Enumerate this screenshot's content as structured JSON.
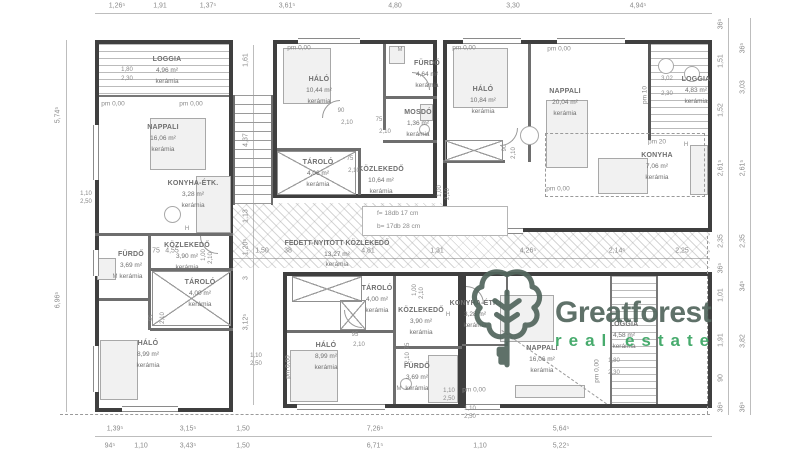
{
  "colors": {
    "wall": "#3f3f3f",
    "partition": "#6e6e6e",
    "text": "#8a8a8a",
    "label": "#6f6f6f",
    "logo_dark": "#53675e",
    "logo_green": "#3aa563"
  },
  "logo": {
    "name": "Greatforest",
    "tagline": "real estate",
    "icon": "tree-key-icon"
  },
  "walkway": {
    "name": "FEDETT-NYITOTT KÖZLEKEDŐ",
    "area": "13,27 m²",
    "finish": "kerámia"
  },
  "stair_note": {
    "line1": "f= 18db 17 cm",
    "line2": "b= 17db 28 cm"
  },
  "rooms": [
    {
      "name": "LOGGIA",
      "area": "4,96 m²",
      "finish": "kerámia",
      "x": 167,
      "y": 54
    },
    {
      "name": "NAPPALI",
      "area": "16,06 m²",
      "finish": "kerámia",
      "x": 163,
      "y": 122
    },
    {
      "name": "KONYHA-ÉTK.",
      "area": "3,28 m²",
      "finish": "kerámia",
      "x": 193,
      "y": 178
    },
    {
      "name": "KÖZLEKEDŐ",
      "area": "3,90 m²",
      "finish": "kerámia",
      "x": 187,
      "y": 240
    },
    {
      "name": "FÜRDŐ",
      "area": "3,69 m²",
      "finish": "kerámia",
      "x": 131,
      "y": 249
    },
    {
      "name": "TÁROLÓ",
      "area": "4,00 m²",
      "finish": "kerámia",
      "x": 200,
      "y": 277
    },
    {
      "name": "HÁLÓ",
      "area": "8,99 m²",
      "finish": "kerámia",
      "x": 148,
      "y": 338
    },
    {
      "name": "HÁLÓ",
      "area": "10,44 m²",
      "finish": "kerámia",
      "x": 319,
      "y": 74
    },
    {
      "name": "FÜRDŐ",
      "area": "4,64 m²",
      "finish": "kerámia",
      "x": 427,
      "y": 58
    },
    {
      "name": "MOSDÓ",
      "area": "1,36 m²",
      "finish": "kerámia",
      "x": 418,
      "y": 107
    },
    {
      "name": "TÁROLÓ",
      "area": "4,06 m²",
      "finish": "kerámia",
      "x": 318,
      "y": 157
    },
    {
      "name": "KÖZLEKEDŐ",
      "area": "10,64 m²",
      "finish": "kerámia",
      "x": 381,
      "y": 164
    },
    {
      "name": "HÁLÓ",
      "area": "10,84 m²",
      "finish": "kerámia",
      "x": 483,
      "y": 84
    },
    {
      "name": "NAPPALI",
      "area": "20,04 m²",
      "finish": "kerámia",
      "x": 565,
      "y": 86
    },
    {
      "name": "LOGGIA",
      "area": "4,83 m²",
      "finish": "kerámia",
      "x": 696,
      "y": 74
    },
    {
      "name": "KONYHA",
      "area": "7,06 m²",
      "finish": "kerámia",
      "x": 657,
      "y": 150
    },
    {
      "name": "TÁROLÓ",
      "area": "4,00 m²",
      "finish": "kerámia",
      "x": 377,
      "y": 283
    },
    {
      "name": "KÖZLEKEDŐ",
      "area": "3,90 m²",
      "finish": "kerámia",
      "x": 421,
      "y": 305
    },
    {
      "name": "HÁLÓ",
      "area": "8,99 m²",
      "finish": "kerámia",
      "x": 326,
      "y": 340
    },
    {
      "name": "FÜRDŐ",
      "area": "3,69 m²",
      "finish": "kerámia",
      "x": 417,
      "y": 361
    },
    {
      "name": "KONYHA-ÉTK.",
      "area": "3,28 m²",
      "finish": "kerámia",
      "x": 475,
      "y": 298
    },
    {
      "name": "NAPPALI",
      "area": "16,06 m²",
      "finish": "kerámia",
      "x": 542,
      "y": 343
    },
    {
      "name": "LOGGIA",
      "area": "4,58 m²",
      "finish": "kerámia",
      "x": 624,
      "y": 319
    }
  ],
  "dims": {
    "top": [
      {
        "t": "1,26⁵",
        "x": 117
      },
      {
        "t": "1,91",
        "x": 160
      },
      {
        "t": "1,37⁵",
        "x": 208
      },
      {
        "t": "3,61⁵",
        "x": 287
      },
      {
        "t": "4,80",
        "x": 395
      },
      {
        "t": "3,30",
        "x": 513
      },
      {
        "t": "4,94⁵",
        "x": 638
      }
    ],
    "bottom": [
      {
        "t": "1,39⁵",
        "x": 115
      },
      {
        "t": "3,15⁵",
        "x": 188
      },
      {
        "t": "1,50",
        "x": 243
      },
      {
        "t": "7,26⁵",
        "x": 375
      },
      {
        "t": "5,64⁵",
        "x": 561
      }
    ],
    "bottom2": [
      {
        "t": "94⁵",
        "x": 110
      },
      {
        "t": "1,10",
        "x": 141
      },
      {
        "t": "3,43⁵",
        "x": 188
      },
      {
        "t": "1,50",
        "x": 243
      },
      {
        "t": "6,71⁵",
        "x": 375
      },
      {
        "t": "1,10",
        "x": 480
      },
      {
        "t": "5,22⁵",
        "x": 561
      }
    ],
    "left": [
      {
        "t": "5,74⁵",
        "y": 115
      },
      {
        "t": "6,96⁵",
        "y": 300
      }
    ],
    "mid": [
      {
        "t": "1,61",
        "y": 60
      },
      {
        "t": "4,37",
        "y": 140
      },
      {
        "t": "1,13",
        "y": 216
      },
      {
        "t": "1,20⁵",
        "y": 247
      },
      {
        "t": "3",
        "y": 278
      },
      {
        "t": "3,12⁵",
        "y": 322
      }
    ],
    "right_inner": [
      {
        "t": "36⁵",
        "y": 24
      },
      {
        "t": "1,51",
        "y": 61
      },
      {
        "t": "1,52",
        "y": 110
      },
      {
        "t": "2,61⁵",
        "y": 168
      },
      {
        "t": "2,35",
        "y": 241
      },
      {
        "t": "36⁵",
        "y": 268
      },
      {
        "t": "1,01",
        "y": 295
      },
      {
        "t": "1,91",
        "y": 340
      },
      {
        "t": "90",
        "y": 378
      },
      {
        "t": "36⁵",
        "y": 407
      }
    ],
    "right_outer": [
      {
        "t": "36⁵",
        "y": 48
      },
      {
        "t": "3,03",
        "y": 87
      },
      {
        "t": "2,61⁵",
        "y": 168
      },
      {
        "t": "2,35",
        "y": 241
      },
      {
        "t": "34⁵",
        "y": 286
      },
      {
        "t": "3,82",
        "y": 341
      },
      {
        "t": "36⁵",
        "y": 407
      }
    ],
    "walkway": [
      {
        "t": "75",
        "x": 156
      },
      {
        "t": "4,55",
        "x": 172
      },
      {
        "t": "1,50",
        "x": 262
      },
      {
        "t": "38",
        "x": 288
      },
      {
        "t": "4,81",
        "x": 368
      },
      {
        "t": "1,31",
        "x": 437
      },
      {
        "t": "4,26⁵",
        "x": 528
      },
      {
        "t": "2,14⁵",
        "x": 617
      },
      {
        "t": "2,25",
        "x": 682
      }
    ]
  },
  "small": [
    {
      "t": "1,80",
      "x": 127,
      "y": 70
    },
    {
      "t": "2,30",
      "x": 127,
      "y": 79
    },
    {
      "t": "1,10",
      "x": 86,
      "y": 194
    },
    {
      "t": "2,50",
      "x": 86,
      "y": 202
    },
    {
      "t": "90",
      "x": 341,
      "y": 111
    },
    {
      "t": "2,10",
      "x": 347,
      "y": 123
    },
    {
      "t": "75",
      "x": 379,
      "y": 120
    },
    {
      "t": "2,10",
      "x": 385,
      "y": 132
    },
    {
      "t": "75",
      "x": 350,
      "y": 159
    },
    {
      "t": "2,10",
      "x": 354,
      "y": 171
    },
    {
      "t": "90",
      "x": 505,
      "y": 148,
      "r": 1
    },
    {
      "t": "2,10",
      "x": 514,
      "y": 153,
      "r": 1
    },
    {
      "t": "3,02",
      "x": 667,
      "y": 79
    },
    {
      "t": "2,30",
      "x": 667,
      "y": 94
    },
    {
      "t": "1,00",
      "x": 440,
      "y": 191,
      "r": 1
    },
    {
      "t": "2,10",
      "x": 448,
      "y": 194,
      "r": 1
    },
    {
      "t": "1,00",
      "x": 204,
      "y": 255,
      "r": 1
    },
    {
      "t": "2,10",
      "x": 211,
      "y": 258,
      "r": 1
    },
    {
      "t": "95",
      "x": 152,
      "y": 318,
      "r": 1
    },
    {
      "t": "2,10",
      "x": 163,
      "y": 318,
      "r": 1
    },
    {
      "t": "95",
      "x": 355,
      "y": 335
    },
    {
      "t": "2,10",
      "x": 359,
      "y": 345
    },
    {
      "t": "75",
      "x": 408,
      "y": 346,
      "r": 1
    },
    {
      "t": "2,10",
      "x": 408,
      "y": 358,
      "r": 1
    },
    {
      "t": "1,00",
      "x": 415,
      "y": 290,
      "r": 1
    },
    {
      "t": "2,10",
      "x": 422,
      "y": 293,
      "r": 1
    },
    {
      "t": "1,10",
      "x": 256,
      "y": 356
    },
    {
      "t": "2,50",
      "x": 256,
      "y": 364
    },
    {
      "t": "1,10",
      "x": 449,
      "y": 391
    },
    {
      "t": "2,50",
      "x": 449,
      "y": 399
    },
    {
      "t": "1,10",
      "x": 470,
      "y": 409
    },
    {
      "t": "2,50",
      "x": 470,
      "y": 417
    },
    {
      "t": "1,80",
      "x": 614,
      "y": 361
    },
    {
      "t": "2,30",
      "x": 614,
      "y": 373
    },
    {
      "t": "M",
      "x": 115,
      "y": 277
    },
    {
      "t": "M",
      "x": 400,
      "y": 50
    },
    {
      "t": "M",
      "x": 399,
      "y": 389
    },
    {
      "t": "H",
      "x": 187,
      "y": 229
    },
    {
      "t": "H",
      "x": 448,
      "y": 315
    },
    {
      "t": "H",
      "x": 686,
      "y": 145
    }
  ],
  "pm": [
    {
      "t": "pm 0,00",
      "x": 113,
      "y": 104
    },
    {
      "t": "pm 0,00",
      "x": 191,
      "y": 104
    },
    {
      "t": "pm 0,00",
      "x": 299,
      "y": 48
    },
    {
      "t": "pm 0,00",
      "x": 464,
      "y": 48
    },
    {
      "t": "pm 0,00",
      "x": 559,
      "y": 49
    },
    {
      "t": "pm 0,00",
      "x": 558,
      "y": 189
    },
    {
      "t": "pm 20",
      "x": 657,
      "y": 142
    },
    {
      "t": "pm 10",
      "x": 645,
      "y": 95,
      "r": 1
    },
    {
      "t": "pm 0,00",
      "x": 288,
      "y": 367,
      "r": 1
    },
    {
      "t": "pm 0,00",
      "x": 474,
      "y": 390
    },
    {
      "t": "pm 0,00",
      "x": 597,
      "y": 371,
      "r": 1
    }
  ]
}
